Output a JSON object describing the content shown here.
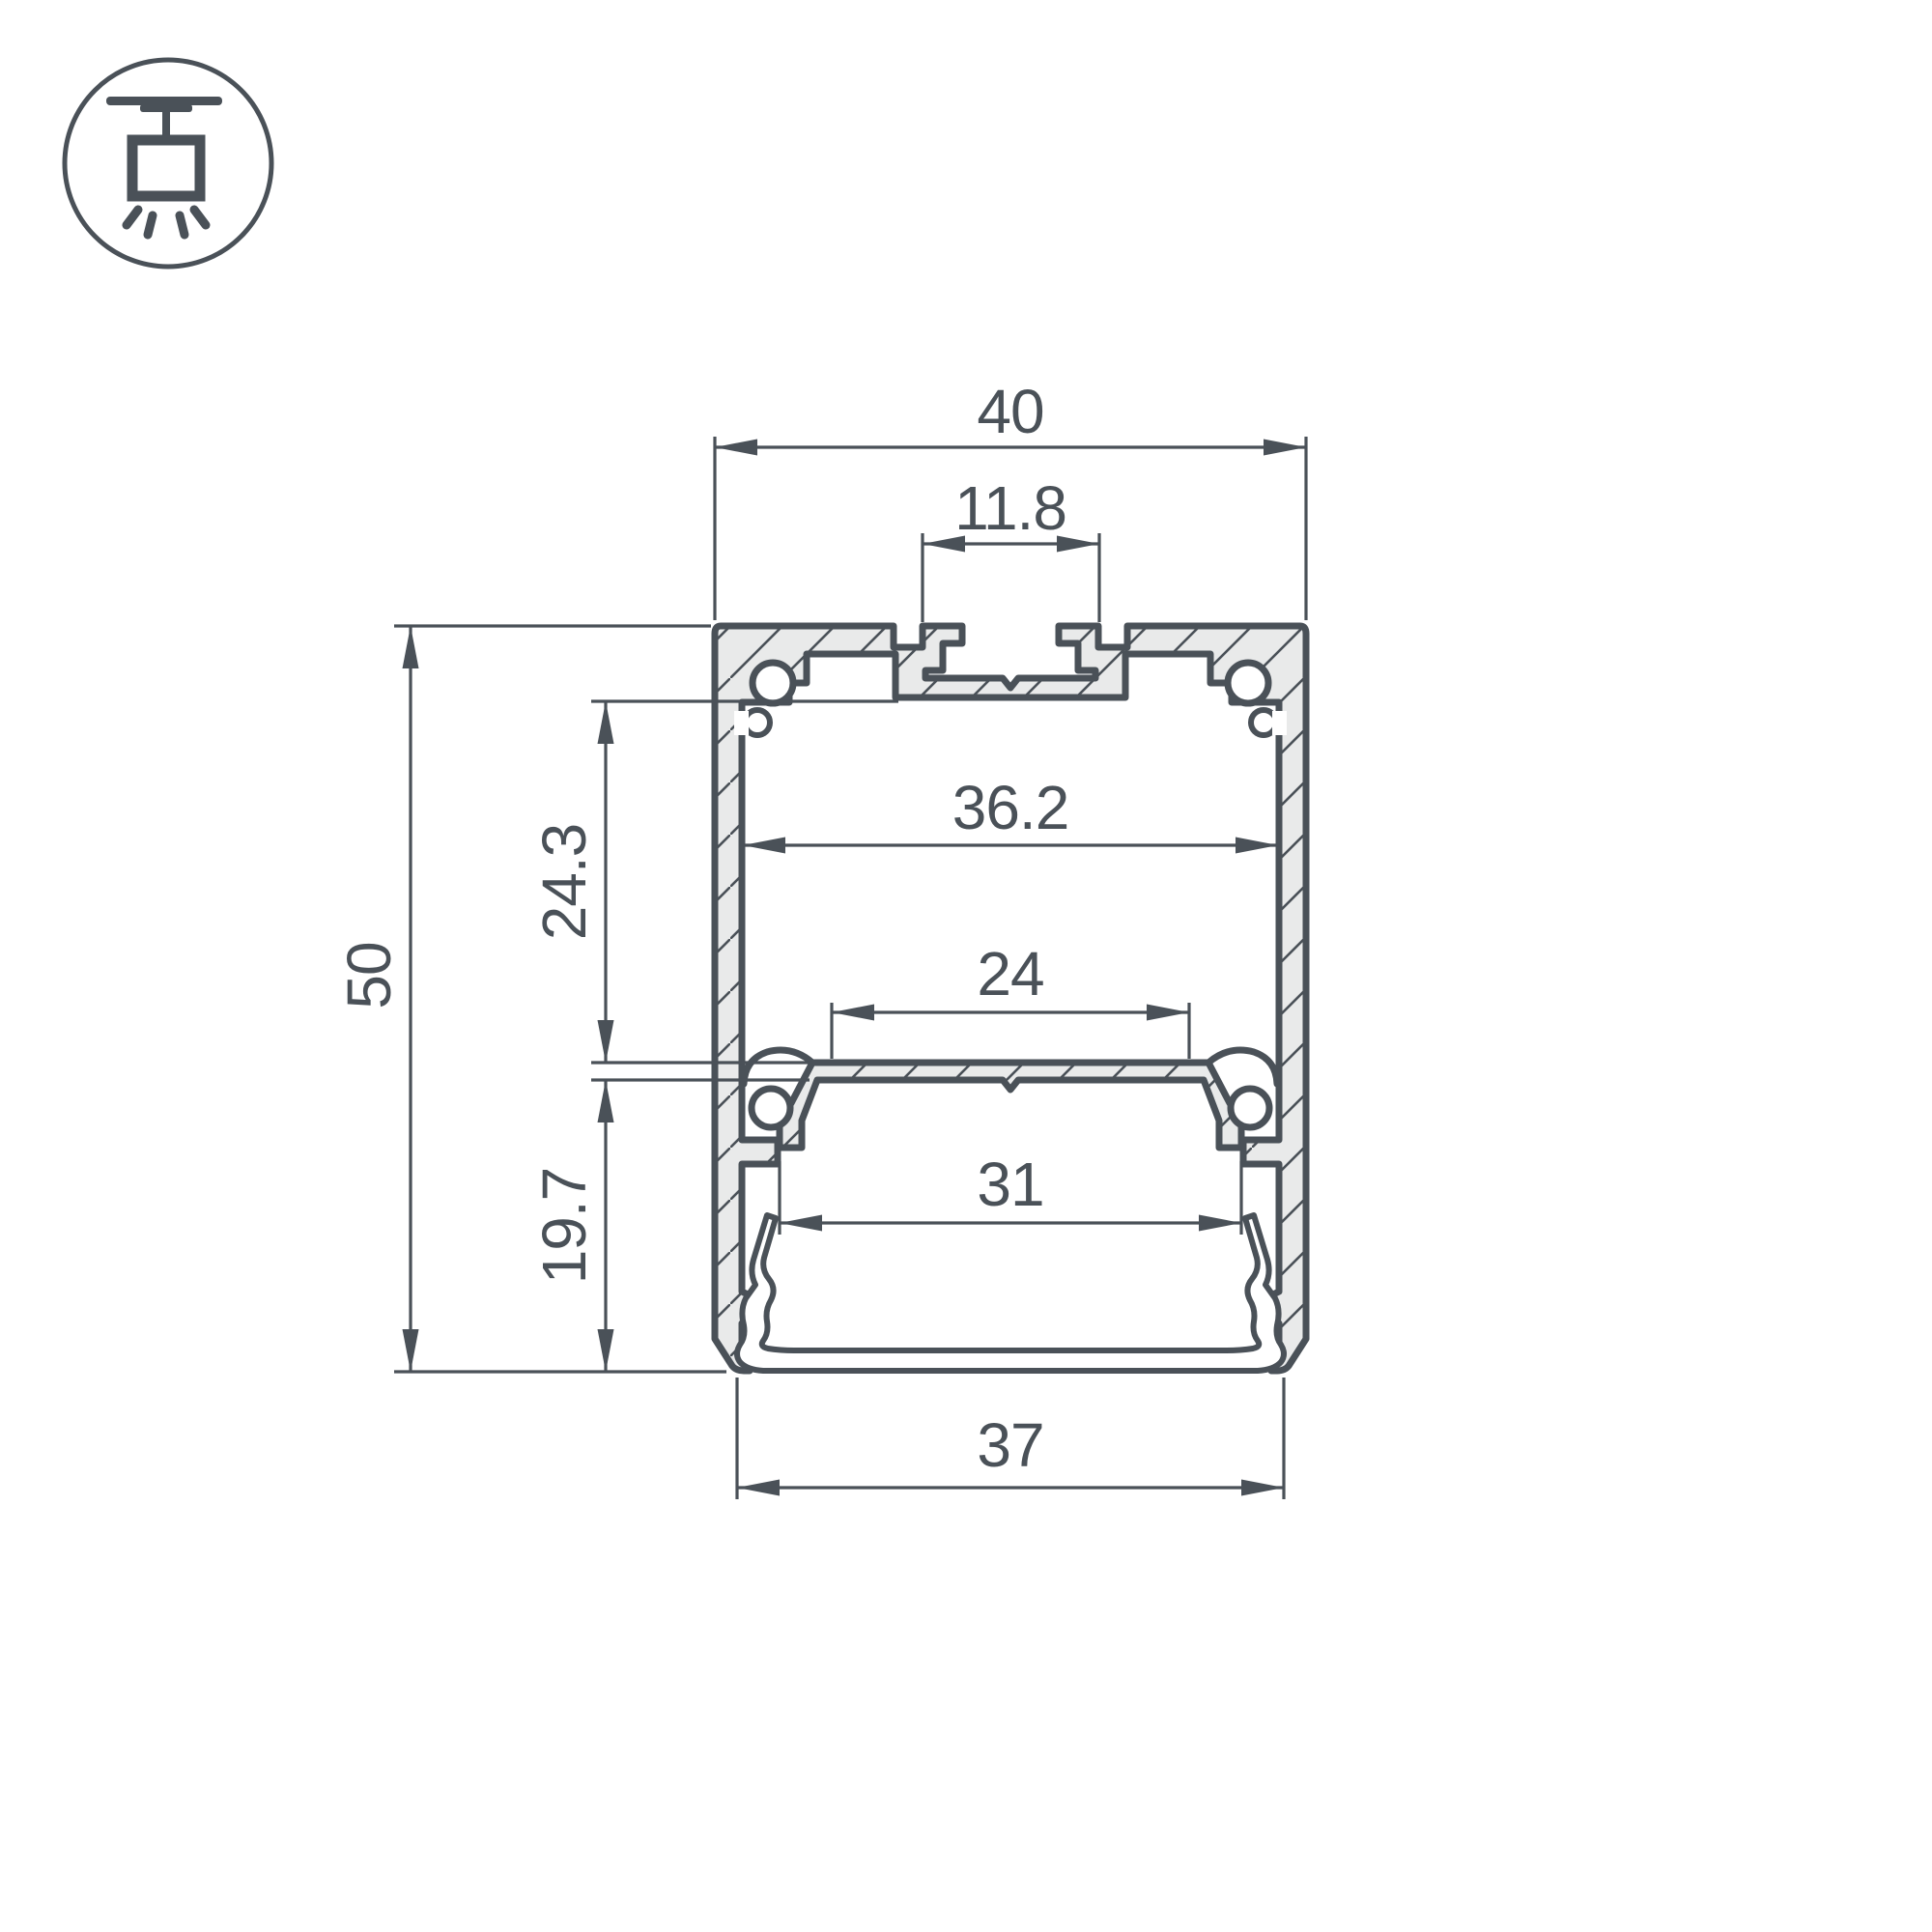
{
  "drawing": {
    "kind": "led-profile-cross-section",
    "icon": "suspended-pendant-light-icon"
  },
  "dimensions": {
    "outer_width": "40",
    "mount_slot_width": "11.8",
    "inner_width": "36.2",
    "plate_window_width": "24",
    "upper_chamber_height": "24.3",
    "overall_height": "50",
    "lower_chamber_width": "31",
    "lower_chamber_height": "19.7",
    "bottom_width": "37"
  },
  "colors": {
    "line": "#4a5158",
    "section_fill": "#e9eaea",
    "background": "#ffffff"
  }
}
